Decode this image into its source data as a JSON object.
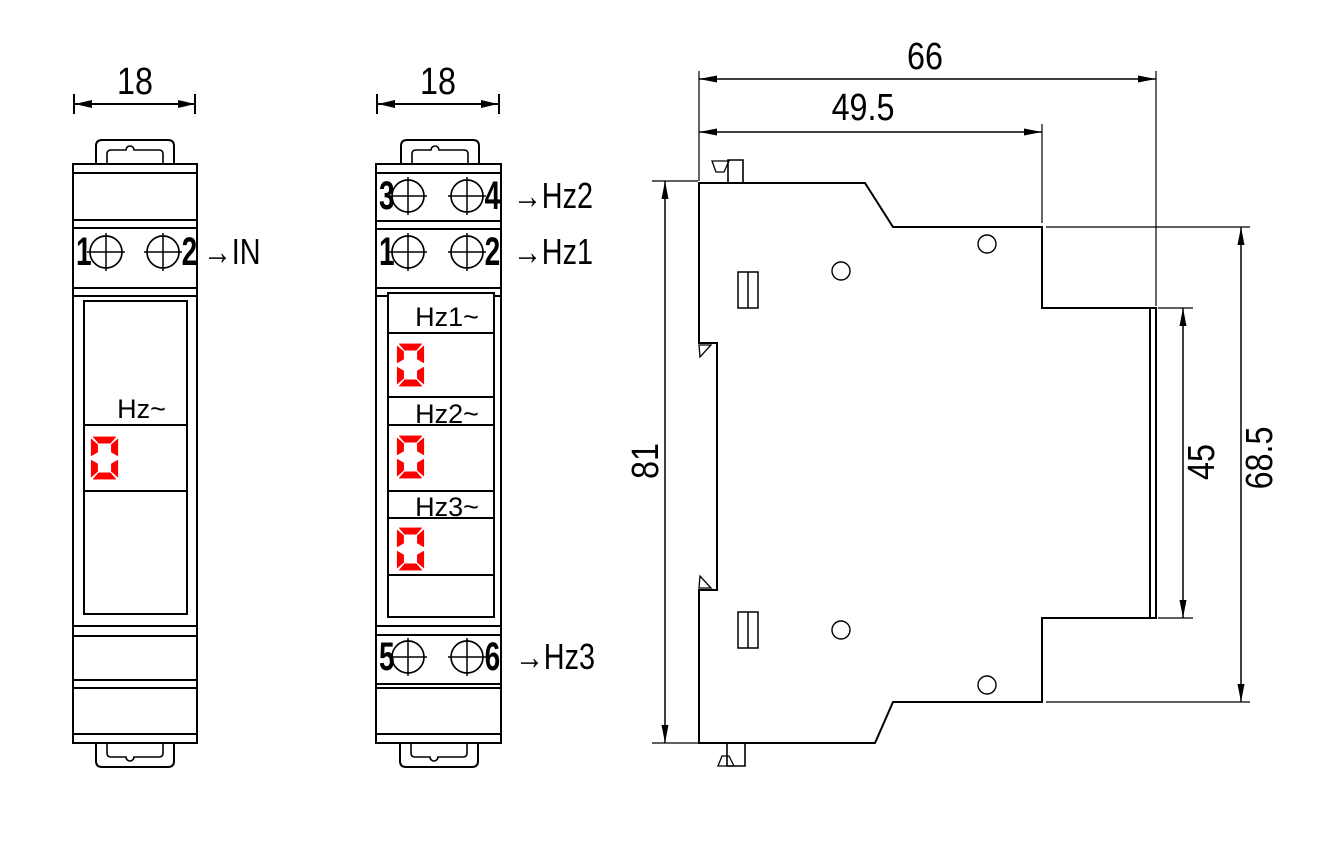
{
  "single_view": {
    "width_dim": "18",
    "terminals": {
      "left": "1",
      "right": "2",
      "label": "→IN"
    },
    "display": {
      "label": "Hz~",
      "value": "000"
    }
  },
  "triple_view": {
    "width_dim": "18",
    "terminal_rows": [
      {
        "left": "3",
        "right": "4",
        "label": "→Hz2"
      },
      {
        "left": "1",
        "right": "2",
        "label": "→Hz1"
      },
      {
        "left": "5",
        "right": "6",
        "label": "→Hz3"
      }
    ],
    "displays": [
      {
        "label": "Hz1~",
        "value": "000"
      },
      {
        "label": "Hz2~",
        "value": "000"
      },
      {
        "label": "Hz3~",
        "value": "000"
      }
    ]
  },
  "side_view": {
    "dim_overall_depth": "66",
    "dim_front_depth": "49.5",
    "dim_height": "81",
    "dim_window_height": "45",
    "dim_body_height": "68.5"
  },
  "colors": {
    "line": "#000000",
    "led_red": "#ff0000",
    "background": "#ffffff"
  }
}
